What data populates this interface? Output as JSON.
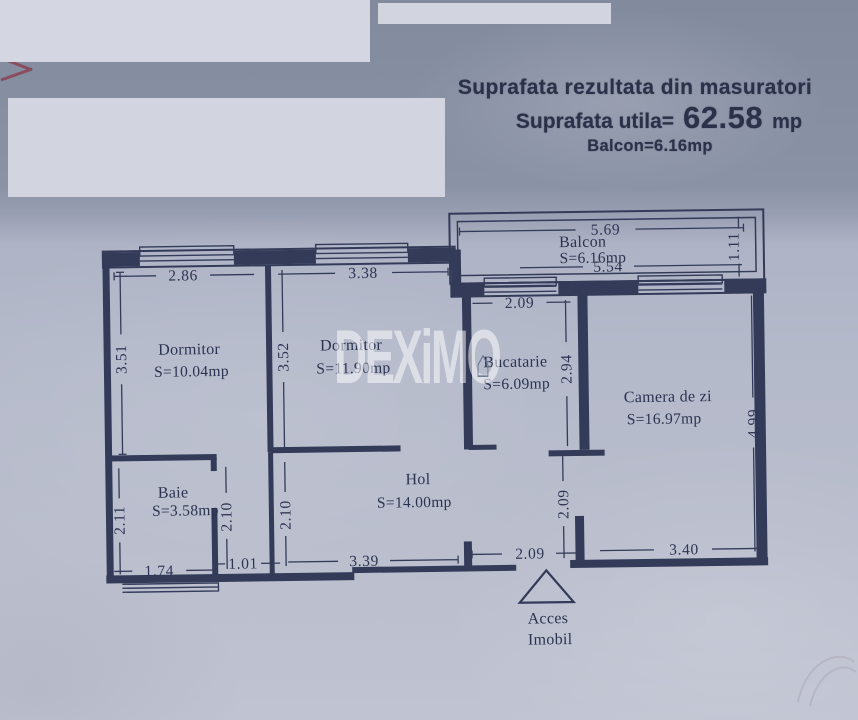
{
  "header": {
    "title": "Suprafata rezultata din masuratori",
    "utila_label": "Suprafata utila=",
    "utila_value": "62.58",
    "utila_unit": "mp",
    "balcon_line": "Balcon=6.16mp"
  },
  "watermark": {
    "text": "DEXiM",
    "o": "O",
    "house_icon": "⌂"
  },
  "plan": {
    "rooms": {
      "balcony": {
        "name": "Balcon",
        "area": "S=6.16mp"
      },
      "bedroom1": {
        "name": "Dormitor",
        "area": "S=10.04mp"
      },
      "bedroom2": {
        "name": "Dormitor",
        "area": "S=11.90mp"
      },
      "kitchen": {
        "name": "Bucatarie",
        "area": "S=6.09mp"
      },
      "living": {
        "name": "Camera de zi",
        "area": "S=16.97mp"
      },
      "bath": {
        "name": "Baie",
        "area": "S=3.58mp"
      },
      "hall": {
        "name": "Hol",
        "area": "S=14.00mp"
      }
    },
    "dims": {
      "balcony_top": "5.69",
      "balcony_bottom": "5.54",
      "balcony_right": "1.11",
      "bedroom1_width": "2.86",
      "bedroom2_width": "3.38",
      "kitchen_width": "2.09",
      "bedroom1_height": "3.51",
      "bedroom2_height": "3.52",
      "kitchen_height": "2.94",
      "living_height": "4.99",
      "bath_height": "2.11",
      "bath_right_height": "2.10",
      "hall_left_height": "2.10",
      "hall_right_height": "2.09",
      "bath_width": "1.74",
      "lobby_width": "1.01",
      "hall_width": "3.39",
      "entry_width": "2.09",
      "living_width": "3.40"
    },
    "access": {
      "line1": "Acces",
      "line2": "Imobil"
    }
  },
  "colors": {
    "wall": "#333b59",
    "paper": "#b5bacb",
    "accent_red": "#8a3d4e"
  }
}
